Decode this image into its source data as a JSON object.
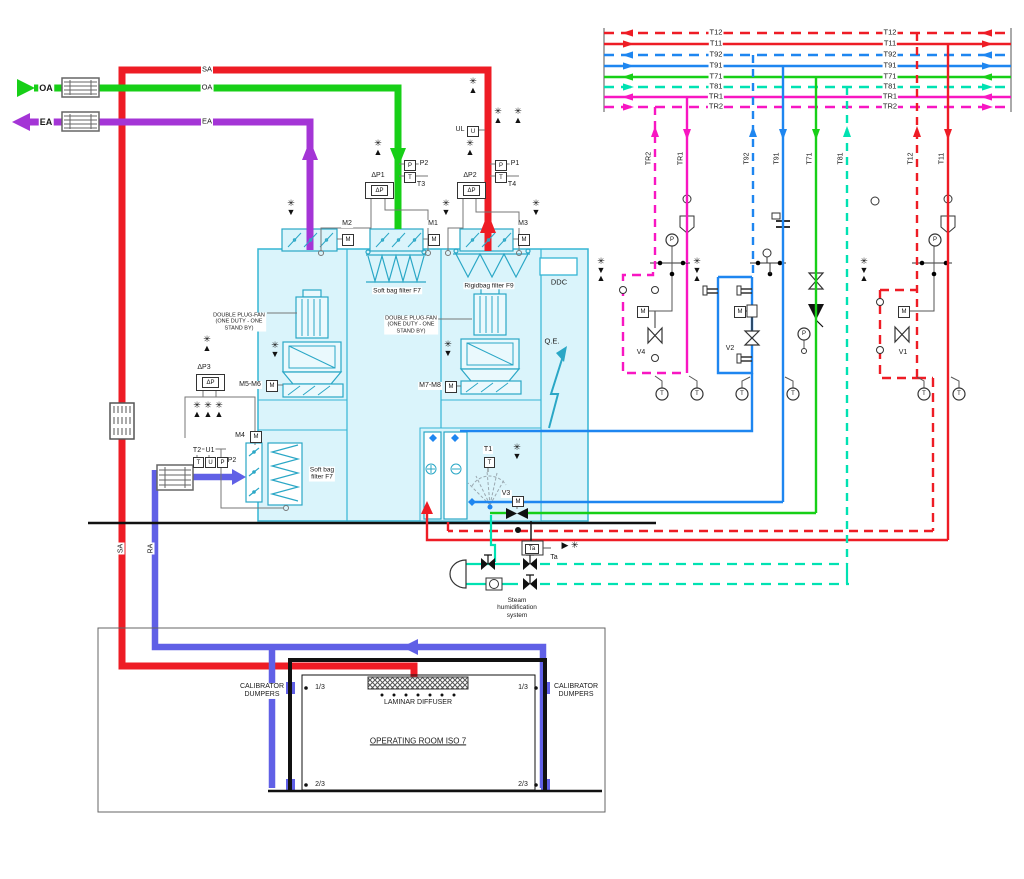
{
  "colors": {
    "red": "#EE1C25",
    "green": "#17CF17",
    "purple": "#A435D6",
    "blue_pipe": "#6060E6",
    "blue_sig": "#1E86F0",
    "magenta": "#F816C2",
    "cyan_sig": "#00E2B2",
    "ahu_fill": "#DAF4FB",
    "ahu_stroke": "#35B5D4",
    "ahu_comp": "#2AA7C6",
    "gray": "#666"
  },
  "glyphs": {
    "snow": "✳",
    "up": "▲",
    "down": "▼",
    "right": "▶",
    "m": "M",
    "t": "T",
    "p": "P",
    "u": "U",
    "dp": "ΔP",
    "ta": "Ta"
  },
  "bus": {
    "x1": 604,
    "x2": 1011,
    "label_x1": 716,
    "label_x2": 890,
    "lines": [
      {
        "label": "T12",
        "color": "red",
        "dash": true,
        "dir": "left",
        "y": 33
      },
      {
        "label": "T11",
        "color": "red",
        "dash": false,
        "dir": "right",
        "y": 44
      },
      {
        "label": "T92",
        "color": "blue_sig",
        "dash": true,
        "dir": "left",
        "y": 55
      },
      {
        "label": "T91",
        "color": "blue_sig",
        "dash": false,
        "dir": "right",
        "y": 66
      },
      {
        "label": "T71",
        "color": "green",
        "dash": false,
        "dir": "left",
        "y": 77
      },
      {
        "label": "T81",
        "color": "cyan_sig",
        "dash": true,
        "dir": "right",
        "y": 87
      },
      {
        "label": "TR1",
        "color": "magenta",
        "dash": false,
        "dir": "left",
        "y": 97
      },
      {
        "label": "TR2",
        "color": "magenta",
        "dash": true,
        "dir": "right",
        "y": 107
      }
    ]
  },
  "drops": [
    {
      "label": "TR2",
      "color": "magenta",
      "dash": true,
      "x": 655,
      "y1": 107,
      "y2": 272,
      "arrow": "up"
    },
    {
      "label": "TR1",
      "color": "magenta",
      "dash": false,
      "x": 687,
      "y1": 97,
      "y2": 263,
      "arrow": "down"
    },
    {
      "label": "T92",
      "color": "blue_sig",
      "dash": true,
      "x": 753,
      "y1": 55,
      "y2": 277,
      "arrow": "up"
    },
    {
      "label": "T91",
      "color": "blue_sig",
      "dash": false,
      "x": 783,
      "y1": 66,
      "y2": 502,
      "arrow": "down"
    },
    {
      "label": "T71",
      "color": "green",
      "dash": false,
      "x": 816,
      "y1": 77,
      "y2": 513,
      "arrow": "down"
    },
    {
      "label": "T81",
      "color": "cyan_sig",
      "dash": true,
      "x": 847,
      "y1": 87,
      "y2": 564,
      "arrow": "up"
    },
    {
      "label": "T12",
      "color": "red",
      "dash": true,
      "x": 917,
      "y1": 33,
      "y2": 378,
      "arrow": "up"
    },
    {
      "label": "T11",
      "color": "red",
      "dash": false,
      "x": 948,
      "y1": 44,
      "y2": 540,
      "arrow": "down"
    }
  ],
  "snowflakes": [
    {
      "x": 378,
      "y": 139,
      "t": "u"
    },
    {
      "x": 473,
      "y": 77,
      "t": "u"
    },
    {
      "x": 470,
      "y": 139,
      "t": "u"
    },
    {
      "x": 498,
      "y": 107,
      "t": "u"
    },
    {
      "x": 518,
      "y": 107,
      "t": "u"
    },
    {
      "x": 291,
      "y": 199,
      "t": "d"
    },
    {
      "x": 446,
      "y": 199,
      "t": "d"
    },
    {
      "x": 536,
      "y": 199,
      "t": "d"
    },
    {
      "x": 275,
      "y": 341,
      "t": "d"
    },
    {
      "x": 448,
      "y": 340,
      "t": "d"
    },
    {
      "x": 207,
      "y": 335,
      "t": "u"
    },
    {
      "x": 197,
      "y": 401,
      "t": "u"
    },
    {
      "x": 208,
      "y": 401,
      "t": "u"
    },
    {
      "x": 219,
      "y": 401,
      "t": "u"
    },
    {
      "x": 517,
      "y": 443,
      "t": "d"
    },
    {
      "x": 601,
      "y": 257,
      "t": "du"
    },
    {
      "x": 697,
      "y": 257,
      "t": "du"
    },
    {
      "x": 864,
      "y": 257,
      "t": "du"
    },
    {
      "x": 570,
      "y": 541,
      "t": "r"
    }
  ],
  "gauges": [
    {
      "x": 662,
      "y": 394,
      "g": "t"
    },
    {
      "x": 697,
      "y": 394,
      "g": "t"
    },
    {
      "x": 742,
      "y": 394,
      "g": "t"
    },
    {
      "x": 793,
      "y": 394,
      "g": "t"
    },
    {
      "x": 924,
      "y": 394,
      "g": "t"
    },
    {
      "x": 959,
      "y": 394,
      "g": "t"
    },
    {
      "x": 672,
      "y": 240,
      "g": "p"
    },
    {
      "x": 935,
      "y": 240,
      "g": "p"
    },
    {
      "x": 804,
      "y": 334,
      "g": "p"
    }
  ],
  "intake": {
    "oa": "OA",
    "ea": "EA"
  },
  "duct_labels": {
    "sa": "SA",
    "oa": "OA",
    "ea": "EA",
    "sa_riser": "SA",
    "ra_riser": "RA"
  },
  "dampers": {
    "m1": "M1",
    "m2": "M2",
    "m3": "M3",
    "m4": "M4",
    "m56": "M5-M6",
    "m78": "M7-M8"
  },
  "sensors": {
    "dp1": "ΔP1",
    "dp2": "ΔP2",
    "dp3": "ΔP3",
    "p1": "P1",
    "p2_supply": "P2",
    "t3": "T3",
    "t4": "T4",
    "ul": "UL",
    "t1": "T1",
    "t2": "T2",
    "u1": "U1",
    "p2_return": "P2",
    "ta": "Ta"
  },
  "valves": {
    "v1": "V1",
    "v2": "V2",
    "v3": "V3",
    "v4": "V4"
  },
  "equipment": {
    "soft_bag_top": "Soft bag filter F7",
    "rigid_bag": "Rigidbag filter F9",
    "soft_bag_lower": "Soft bag\nfilter F7",
    "plug_fan_note": "DOUBLE PLUG-FAN\n(ONE DUTY - ONE\nSTAND BY)",
    "ddc": "DDC",
    "qe": "Q.E.",
    "steam": "Steam\nhumidification\nsystem"
  },
  "room": {
    "name": "OPERATING ROOM ISO 7",
    "diffuser": "LAMINAR DIFFUSER",
    "calibrator": "CALIBRATOR\nDUMPERS",
    "frac_top": "1/3",
    "frac_bottom": "2/3"
  }
}
